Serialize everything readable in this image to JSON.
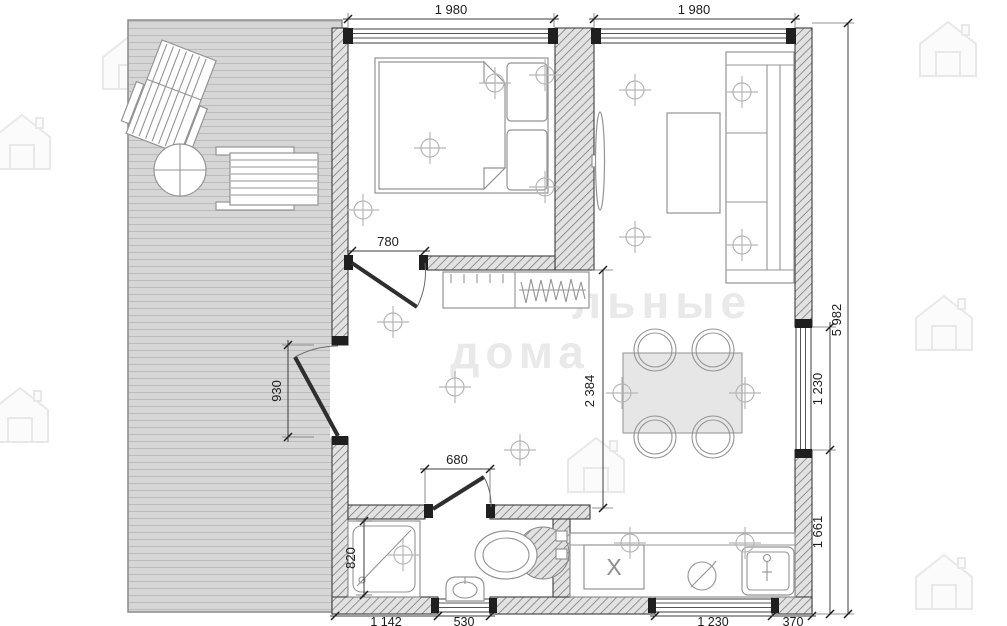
{
  "plan": {
    "type": "floor-plan",
    "description_units": "mm",
    "dimensions": {
      "top_bedroom_width": "1 980",
      "top_living_width": "1 980",
      "right_total_depth": "5 982",
      "right_window_height": "1 230",
      "right_kitchen_zone": "1 661",
      "bedroom_door_width": "780",
      "entrance_door_width": "930",
      "bathroom_door_width": "680",
      "bathroom_inner_depth": "820",
      "hall_open_depth": "2 384",
      "bottom_bath_wall": "1 142",
      "bottom_bath_window": "530",
      "bottom_kitchen_window": "1 230",
      "bottom_corner_wall": "370"
    },
    "labels": {
      "kitchen_unit_x": "X"
    },
    "watermark": {
      "word1": "льные",
      "word2": "дома"
    },
    "colors": {
      "wall_hatch_bg": "#e2e2e2",
      "wall_hatch_line": "#7d7d7d",
      "deck_fill": "#d6d6d6",
      "post_dark": "#1f1f1f",
      "table_fill": "#e6e6e6",
      "dim_text": "#1c1c1c"
    }
  }
}
